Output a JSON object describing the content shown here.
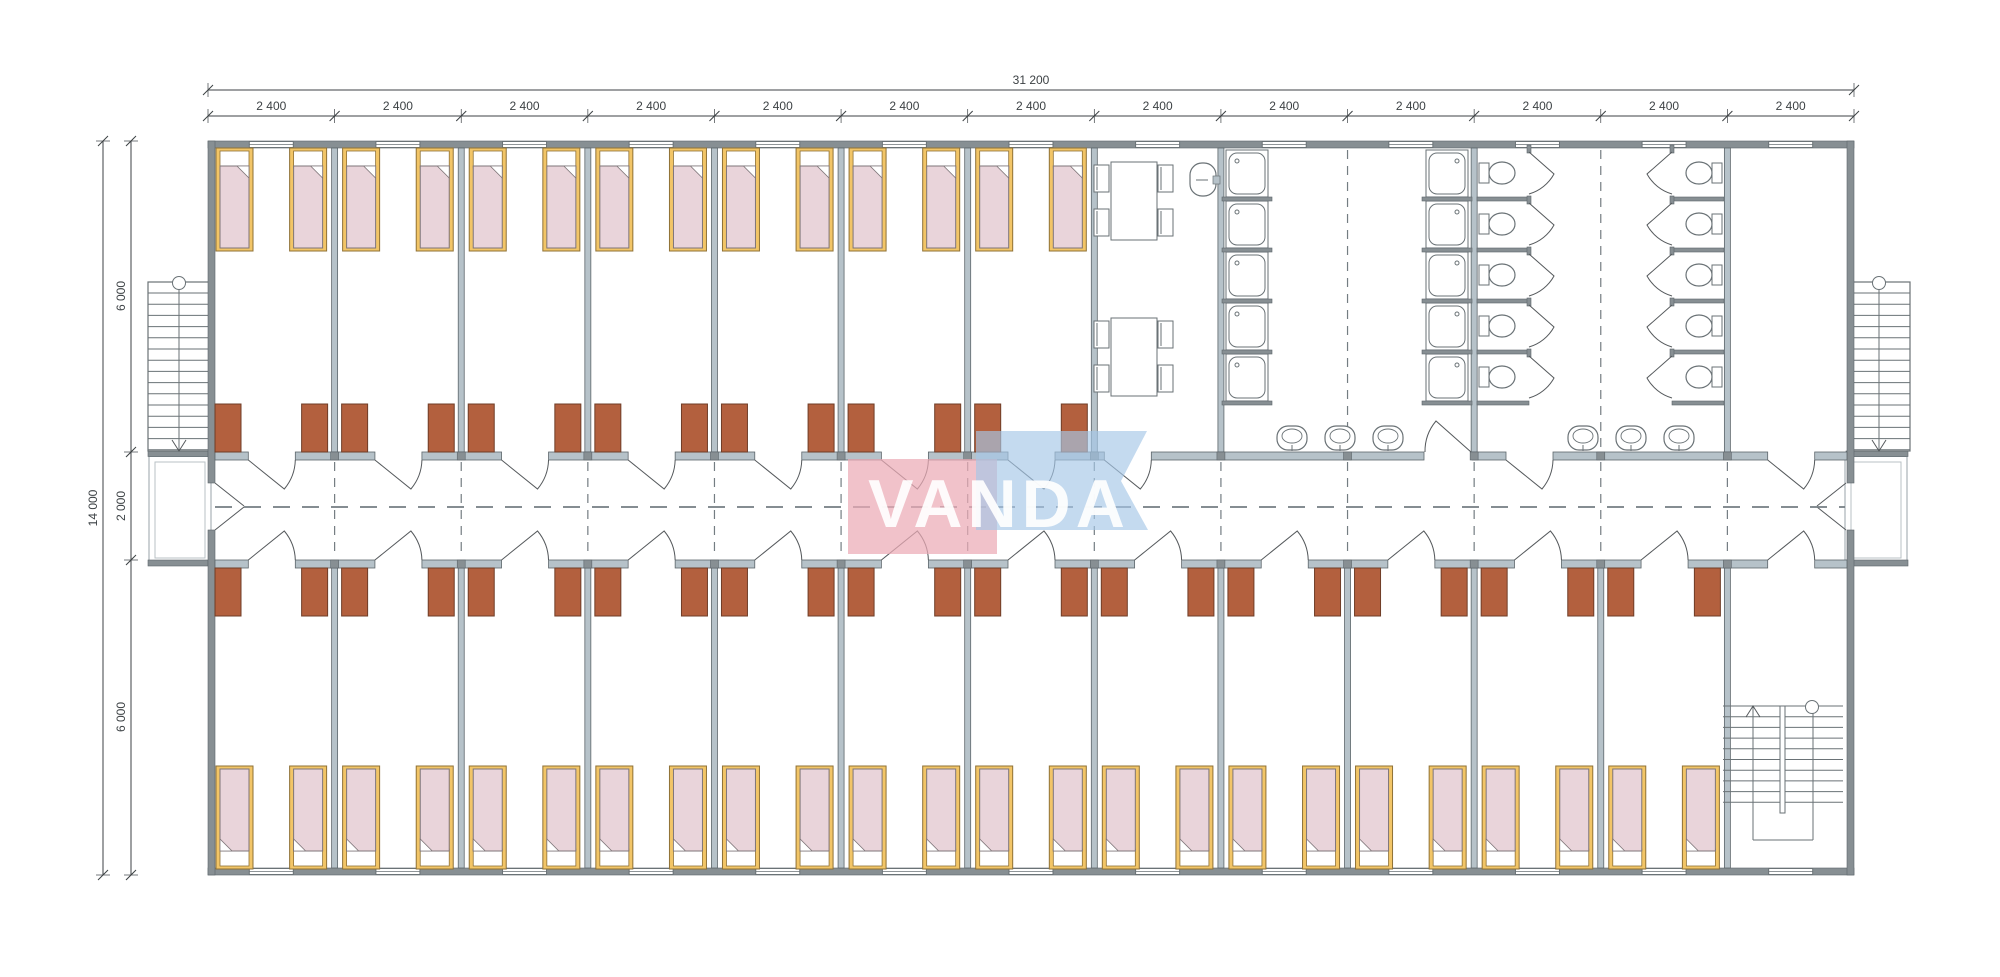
{
  "dimensions": {
    "overall_width": "31 200",
    "modules": [
      "2 400",
      "2 400",
      "2 400",
      "2 400",
      "2 400",
      "2 400",
      "2 400",
      "2 400",
      "2 400",
      "2 400",
      "2 400",
      "2 400",
      "2 400"
    ],
    "overall_height": "14 000",
    "height_segments": [
      "6 000",
      "2 000",
      "6 000"
    ]
  },
  "logo": {
    "text": "VANDA",
    "pink": "#ecaab5",
    "blue": "#a5c7e7",
    "letter_color": "#ffffff"
  },
  "plan": {
    "module_count": 13,
    "top_bedrooms": 7,
    "bottom_bedrooms": 12,
    "beds_per_room": 2,
    "desks_per_room": 2,
    "dining_tables": 2,
    "chairs_per_table": 4,
    "shower_stalls": 10,
    "toilet_stalls": 10,
    "corridor_washbasins": 6,
    "dining_sinks": 1,
    "external_staircases": 2,
    "internal_staircases": 1
  },
  "colors": {
    "wall": "#878f93",
    "wall_light": "#b6c2c9",
    "wall_stroke": "#5d666b",
    "bed_frame": "#f2c567",
    "bed_frame_stroke": "#8f7136",
    "mattress": "#e9d4da",
    "mattress_stroke": "#7e7578",
    "pillow": "#ffffff",
    "desk": "#b3603e",
    "desk_stroke": "#6f3d27",
    "fixture_stroke": "#6a7276",
    "door_stroke": "#55595c",
    "dash": "#747d82",
    "dim": "#3c4144"
  }
}
